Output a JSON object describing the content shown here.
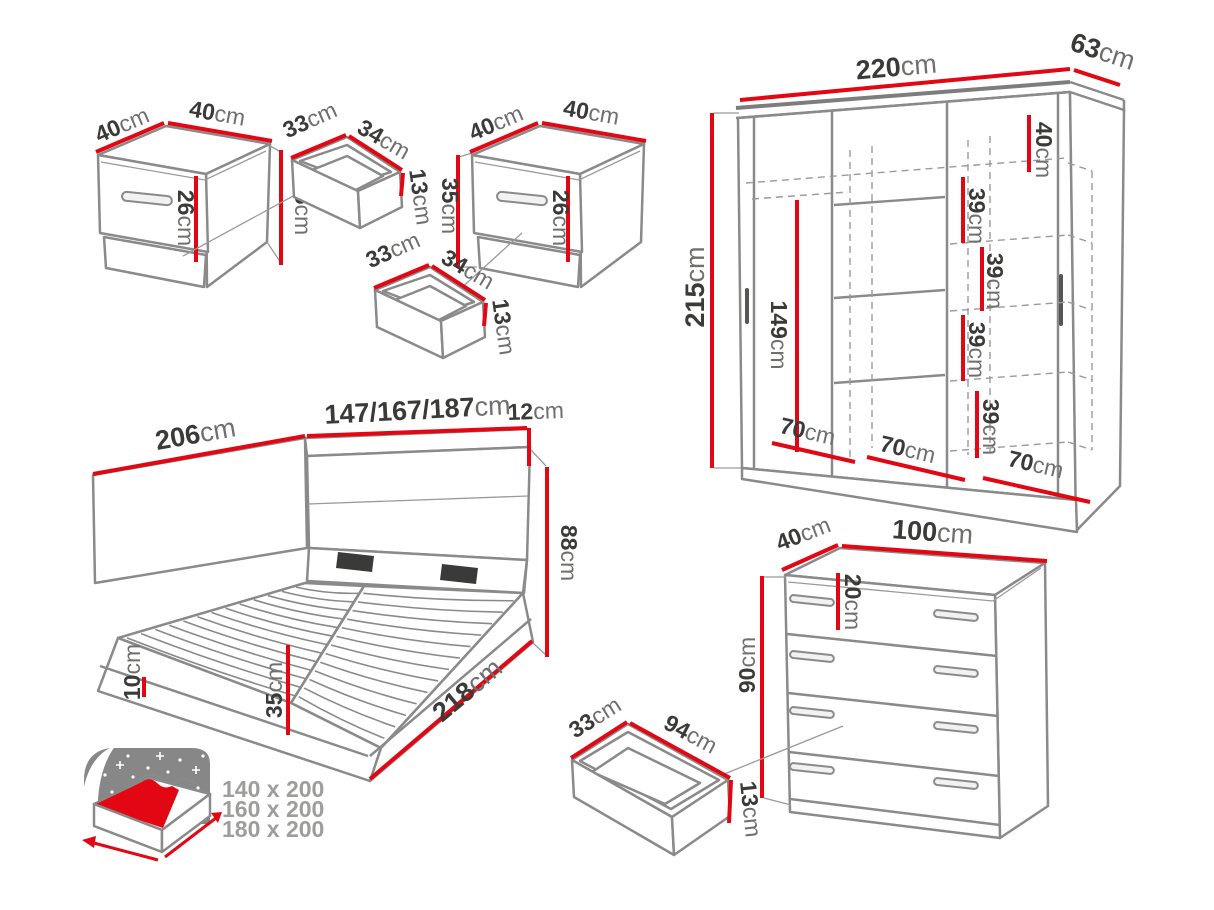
{
  "unit": "cm",
  "colors": {
    "dimension_red": "#e30613",
    "outline_gray": "#8a8a8a",
    "number_dark": "#3a3a39",
    "unit_gray": "#6f6f6e",
    "legend_text_gray": "#9d9d9c"
  },
  "nightstand_left": {
    "depth": "40",
    "width": "40",
    "height": "35",
    "drawer_front": "26"
  },
  "drawer_left": {
    "depth": "33",
    "width": "34",
    "height": "13"
  },
  "nightstand_right": {
    "depth": "40",
    "width": "40",
    "height": "35",
    "drawer_front": "26"
  },
  "drawer_right": {
    "depth": "33",
    "width": "34",
    "height": "13"
  },
  "wardrobe": {
    "width": "220",
    "depth": "63",
    "height": "215",
    "hanging": "149",
    "gap_top": "40",
    "gap1": "39",
    "gap2": "39",
    "gap3": "39",
    "gap4": "39",
    "section1": "70",
    "section2": "70",
    "section3": "70"
  },
  "bed": {
    "side": "206",
    "widths": "147/167/187",
    "top_panel": "12",
    "headboard": "88",
    "plinth": "10",
    "frame": "35",
    "length": "218"
  },
  "chest": {
    "depth": "40",
    "width": "100",
    "height": "90",
    "drawer_top": "20"
  },
  "chest_drawer": {
    "depth": "33",
    "width": "94",
    "height": "13"
  },
  "legend": {
    "size1": "140 x 200",
    "size2": "160 x 200",
    "size3": "180 x 200"
  }
}
